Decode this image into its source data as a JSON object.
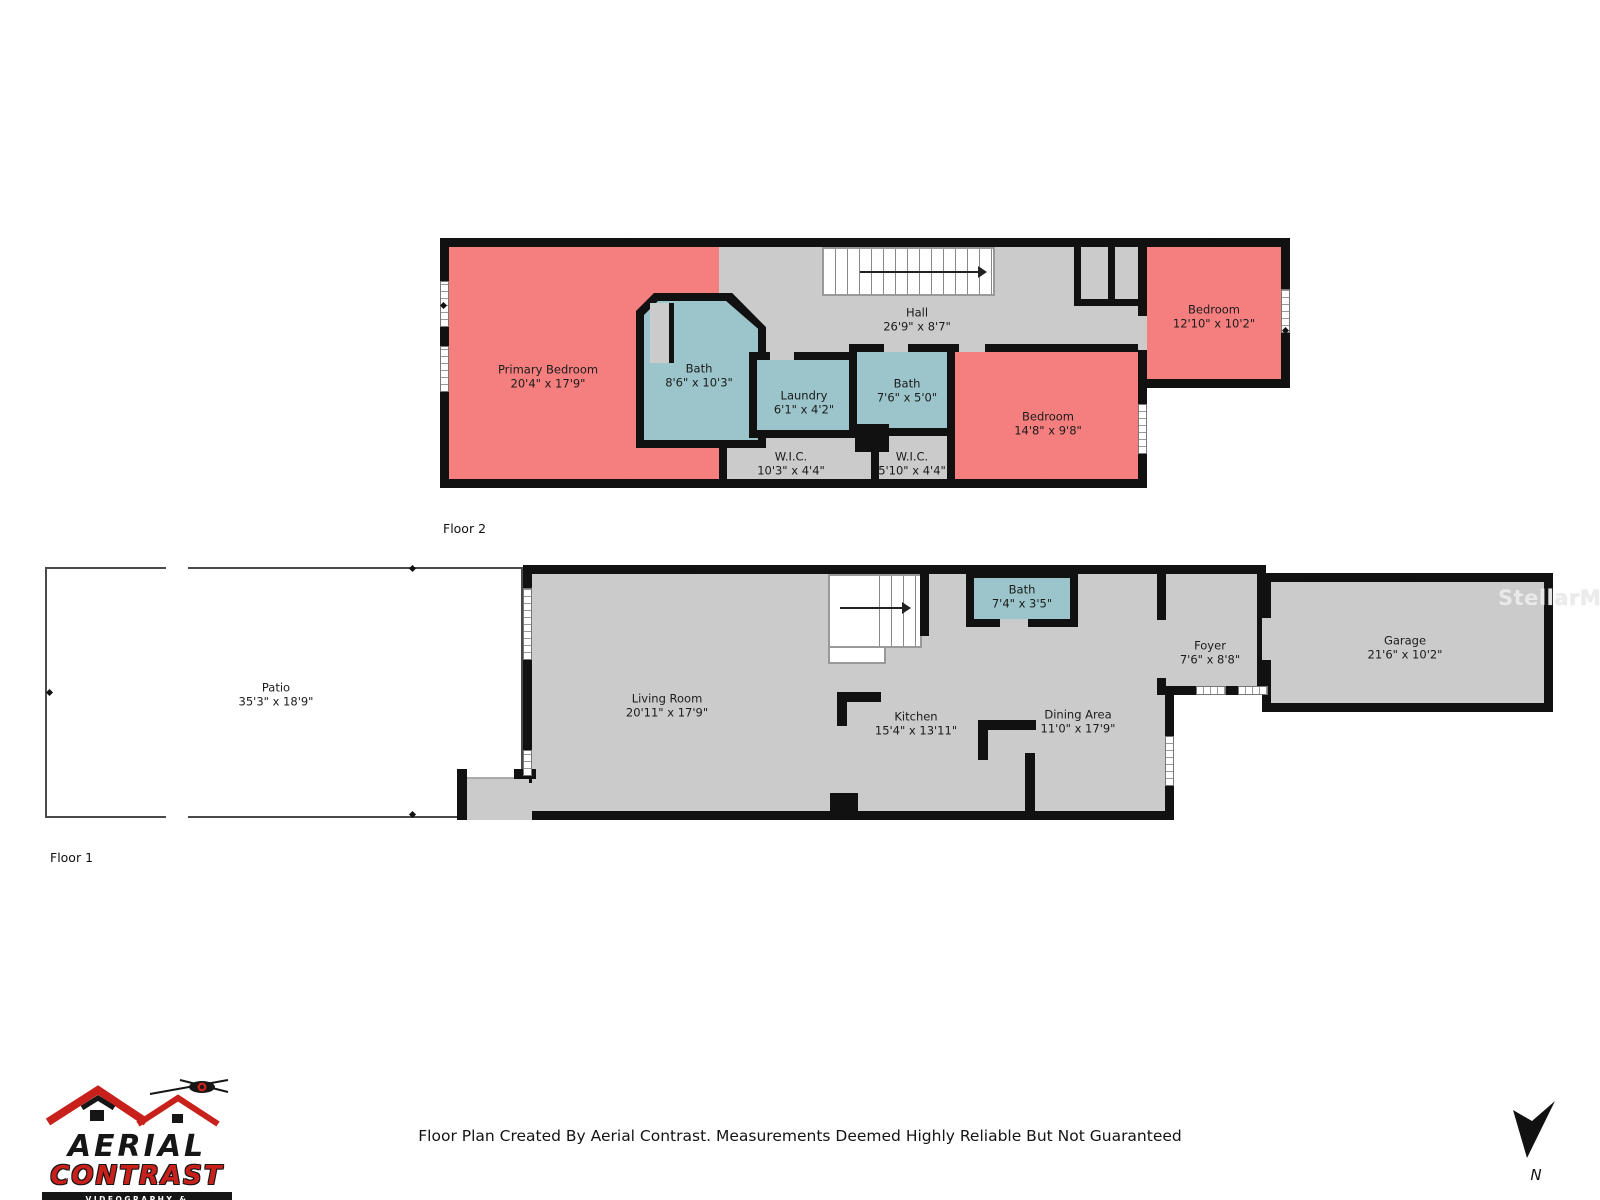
{
  "meta": {
    "footer": "Floor Plan Created By Aerial Contrast. Measurements Deemed Highly Reliable But Not Guaranteed",
    "watermark": "StellarMLS",
    "north_label": "N"
  },
  "logo": {
    "line1": "AERIAL",
    "line2": "CONTRAST",
    "tagline": "VIDEOGRAPHY & PHOTOGRAPHY"
  },
  "colors": {
    "bedroom": "#F57F7F",
    "wet_room": "#9BC5CB",
    "common": "#CBCBCB",
    "wall": "#111111",
    "logo_red": "#C8201B"
  },
  "floor2": {
    "label": "Floor 2",
    "rooms": [
      {
        "name": "Primary Bedroom",
        "dims": "20'4\" x 17'9\""
      },
      {
        "name": "Bath",
        "dims": "8'6\" x 10'3\""
      },
      {
        "name": "Laundry",
        "dims": "6'1\" x 4'2\""
      },
      {
        "name": "Hall",
        "dims": "26'9\" x 8'7\""
      },
      {
        "name": "Bath",
        "dims": "7'6\" x 5'0\""
      },
      {
        "name": "W.I.C.",
        "dims": "10'3\" x 4'4\""
      },
      {
        "name": "W.I.C.",
        "dims": "5'10\" x 4'4\""
      },
      {
        "name": "Bedroom",
        "dims": "14'8\" x 9'8\""
      },
      {
        "name": "Bedroom",
        "dims": "12'10\" x 10'2\""
      }
    ]
  },
  "floor1": {
    "label": "Floor 1",
    "rooms": [
      {
        "name": "Patio",
        "dims": "35'3\" x 18'9\""
      },
      {
        "name": "Living Room",
        "dims": "20'11\" x 17'9\""
      },
      {
        "name": "Bath",
        "dims": "7'4\" x 3'5\""
      },
      {
        "name": "Kitchen",
        "dims": "15'4\" x 13'11\""
      },
      {
        "name": "Dining Area",
        "dims": "11'0\" x 17'9\""
      },
      {
        "name": "Foyer",
        "dims": "7'6\" x 8'8\""
      },
      {
        "name": "Garage",
        "dims": "21'6\" x 10'2\""
      }
    ]
  }
}
